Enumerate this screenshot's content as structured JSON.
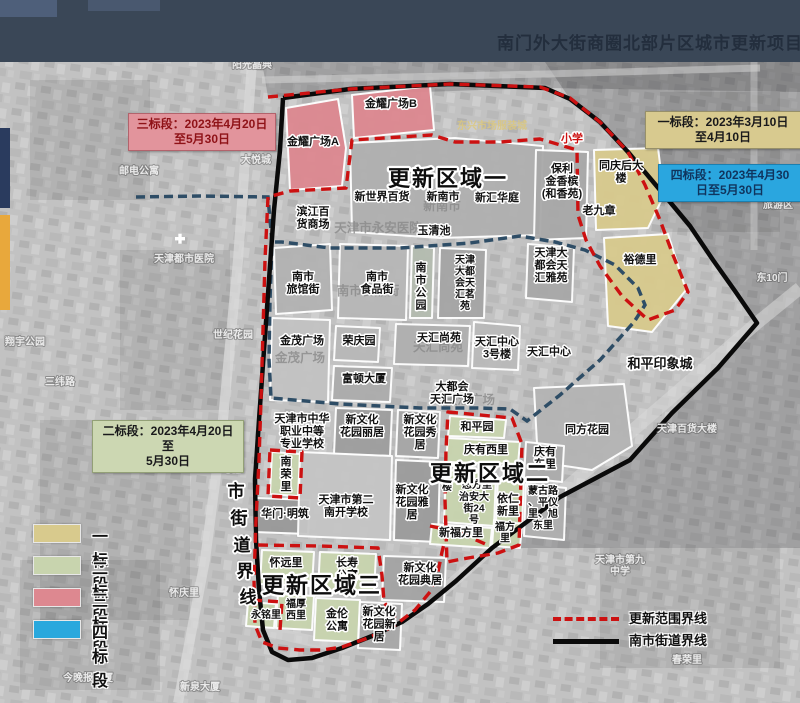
{
  "header": {
    "title": "南门外大街商圈北部片区城市更新项目"
  },
  "colors": {
    "stage1": "#d8ca8d",
    "stage2": "#c8d4ae",
    "stage3": "#dd8890",
    "stage4": "#29a8dd",
    "renewal_boundary": "#cc1111",
    "street_boundary": "#0a0a0a",
    "district_boundary": "#2e4d66",
    "header_bg": "#3a4757"
  },
  "stage_boxes": {
    "s1": {
      "line1": "一标段：2023年3月10日",
      "line2": "至4月10日"
    },
    "s2": {
      "line1": "二标段：2023年4月20日至",
      "line2": "5月30日"
    },
    "s3": {
      "line1": "三标段：2023年4月20日",
      "line2": "至5月30日"
    },
    "s4": {
      "line1": "四标段：2023年4月30",
      "line2": "日至5月30日"
    }
  },
  "legend": {
    "stages": [
      {
        "label": "一标段",
        "color": "#d8ca8d"
      },
      {
        "label": "二标段",
        "color": "#c8d4ae"
      },
      {
        "label": "三标段",
        "color": "#dd8890"
      },
      {
        "label": "四标段",
        "color": "#29a8dd"
      }
    ],
    "lines": [
      {
        "label": "更新范围界线",
        "style": "red-dashed"
      },
      {
        "label": "南市街道界线",
        "style": "black-solid"
      }
    ]
  },
  "street_boundary": {
    "text": "南市街道界线",
    "chars": [
      {
        "c": "南",
        "x": 234,
        "y": 470
      },
      {
        "c": "市",
        "x": 236,
        "y": 497
      },
      {
        "c": "街",
        "x": 239,
        "y": 524
      },
      {
        "c": "道",
        "x": 242,
        "y": 551
      },
      {
        "c": "界",
        "x": 245,
        "y": 577
      },
      {
        "c": "线",
        "x": 248,
        "y": 603
      }
    ]
  },
  "map_labels": [
    {
      "t": "新南市",
      "x": 442,
      "y": 210,
      "cls": "ghost"
    },
    {
      "t": "天津市永安医院",
      "x": 378,
      "y": 232,
      "cls": "ghost"
    },
    {
      "t": "南市食品街",
      "x": 368,
      "y": 295,
      "cls": "ghost"
    },
    {
      "t": "金茂广场",
      "x": 300,
      "y": 362,
      "cls": "ghost"
    },
    {
      "t": "天汇尚苑",
      "x": 438,
      "y": 351,
      "cls": "ghost"
    },
    {
      "t": "天汇广场",
      "x": 470,
      "y": 404,
      "cls": "ghost"
    },
    {
      "t": "阳光晶典",
      "x": 252,
      "y": 68,
      "cls": "faint"
    },
    {
      "t": "铜锣湾花园",
      "x": 500,
      "y": 56,
      "cls": "faint"
    },
    {
      "t": "邮电公寓",
      "x": 139,
      "y": 174,
      "cls": "faint"
    },
    {
      "t": "大悦城",
      "x": 256,
      "y": 163,
      "cls": "faint"
    },
    {
      "t": "天津都市医院",
      "x": 184,
      "y": 262,
      "cls": "faint"
    },
    {
      "t": "世纪花园",
      "x": 233,
      "y": 338,
      "cls": "faint"
    },
    {
      "t": "翔宇公园",
      "x": 25,
      "y": 345,
      "cls": "faint"
    },
    {
      "t": "三纬路",
      "x": 60,
      "y": 385,
      "cls": "faint"
    },
    {
      "t": "紫光苑小区",
      "x": 204,
      "y": 465,
      "cls": "faint"
    },
    {
      "t": "怀庆里",
      "x": 184,
      "y": 596,
      "cls": "faint"
    },
    {
      "t": "今晚报大厦",
      "x": 88,
      "y": 681,
      "cls": "faint"
    },
    {
      "t": "新泉大厦",
      "x": 200,
      "y": 690,
      "cls": "faint"
    },
    {
      "t": "东10门",
      "x": 772,
      "y": 281,
      "cls": "faint"
    },
    {
      "t": "旅游区",
      "x": 778,
      "y": 208,
      "cls": "faint"
    },
    {
      "t": "天津百货大楼",
      "x": 687,
      "y": 432,
      "cls": "faint"
    },
    {
      "t": "天津市第九\n中学",
      "x": 620,
      "y": 563,
      "cls": "faint"
    },
    {
      "t": "春荣里",
      "x": 687,
      "y": 663,
      "cls": "faint"
    },
    {
      "t": "东兴市场服装城",
      "x": 492,
      "y": 129,
      "cls": "faint-y"
    },
    {
      "t": "金耀广场A",
      "x": 313,
      "y": 145,
      "cls": "blk"
    },
    {
      "t": "金耀广场B",
      "x": 391,
      "y": 107,
      "cls": "blk"
    },
    {
      "t": "新世界百货",
      "x": 382,
      "y": 200,
      "cls": "blk"
    },
    {
      "t": "新南市",
      "x": 443,
      "y": 200,
      "cls": "blk"
    },
    {
      "t": "新汇华庭",
      "x": 497,
      "y": 201,
      "cls": "blk"
    },
    {
      "t": "滨江百\n货商场",
      "x": 313,
      "y": 215,
      "cls": "blk"
    },
    {
      "t": "玉清池",
      "x": 434,
      "y": 234,
      "cls": "blk"
    },
    {
      "t": "保利\n金香槟\n(和香苑)",
      "x": 562,
      "y": 172,
      "cls": "blk"
    },
    {
      "t": "小学",
      "x": 572,
      "y": 142,
      "cls": "red"
    },
    {
      "t": "同庆后大\n楼",
      "x": 621,
      "y": 169,
      "cls": "blk"
    },
    {
      "t": "老九章",
      "x": 599,
      "y": 214,
      "cls": "blk"
    },
    {
      "t": "裕德里",
      "x": 640,
      "y": 263,
      "cls": "blk"
    },
    {
      "t": "天津大\n都会天\n汇雅苑",
      "x": 551,
      "y": 256,
      "cls": "blk"
    },
    {
      "t": "南市\n旅馆街",
      "x": 303,
      "y": 280,
      "cls": "blk"
    },
    {
      "t": "南市\n食品街",
      "x": 377,
      "y": 280,
      "cls": "blk"
    },
    {
      "t": "南\n市\n公\n园",
      "x": 421,
      "y": 271,
      "cls": "blk"
    },
    {
      "t": "天津\n大都\n会天\n汇茗\n苑",
      "x": 465,
      "y": 263,
      "cls": "blk-s"
    },
    {
      "t": "金茂广场",
      "x": 302,
      "y": 344,
      "cls": "blk"
    },
    {
      "t": "荣庆园",
      "x": 359,
      "y": 344,
      "cls": "blk"
    },
    {
      "t": "天汇尚苑",
      "x": 439,
      "y": 341,
      "cls": "blk"
    },
    {
      "t": "天汇中心\n3号楼",
      "x": 497,
      "y": 345,
      "cls": "blk"
    },
    {
      "t": "天汇中心",
      "x": 549,
      "y": 355,
      "cls": "blk"
    },
    {
      "t": "富顿大厦",
      "x": 364,
      "y": 382,
      "cls": "blk"
    },
    {
      "t": "大都会\n天汇广场",
      "x": 452,
      "y": 390,
      "cls": "blk"
    },
    {
      "t": "和平印象城",
      "x": 660,
      "y": 368,
      "cls": "blk-m"
    },
    {
      "t": "同方花园",
      "x": 587,
      "y": 433,
      "cls": "blk"
    },
    {
      "t": "天津市中华\n职业中等\n专业学校",
      "x": 302,
      "y": 422,
      "cls": "blk"
    },
    {
      "t": "新文化\n花园丽居",
      "x": 362,
      "y": 423,
      "cls": "blk"
    },
    {
      "t": "新文化\n花园秀\n居",
      "x": 420,
      "y": 423,
      "cls": "blk"
    },
    {
      "t": "和平园",
      "x": 477,
      "y": 430,
      "cls": "blk"
    },
    {
      "t": "庆有西里",
      "x": 486,
      "y": 453,
      "cls": "blk"
    },
    {
      "t": "庆有\n东里",
      "x": 545,
      "y": 455,
      "cls": "blk"
    },
    {
      "t": "南\n荣\n里",
      "x": 286,
      "y": 465,
      "cls": "blk"
    },
    {
      "t": "华门·明筑",
      "x": 285,
      "y": 517,
      "cls": "blk"
    },
    {
      "t": "天津市第二\n南开学校",
      "x": 346,
      "y": 503,
      "cls": "blk"
    },
    {
      "t": "新文化\n花园雅\n居",
      "x": 412,
      "y": 493,
      "cls": "blk"
    },
    {
      "t": "楼",
      "x": 447,
      "y": 490,
      "cls": "blk-s"
    },
    {
      "t": "恕方里",
      "x": 477,
      "y": 488,
      "cls": "blk-s"
    },
    {
      "t": "治安大\n街24\n号",
      "x": 474,
      "y": 500,
      "cls": "blk-s"
    },
    {
      "t": "依仁\n新里",
      "x": 508,
      "y": 502,
      "cls": "blk"
    },
    {
      "t": "蒙古路\n、平仪\n里、旭\n东里",
      "x": 543,
      "y": 494,
      "cls": "blk-s"
    },
    {
      "t": "新福方里",
      "x": 461,
      "y": 536,
      "cls": "blk"
    },
    {
      "t": "福方\n里",
      "x": 505,
      "y": 530,
      "cls": "blk-s"
    },
    {
      "t": "怀远里",
      "x": 286,
      "y": 566,
      "cls": "blk"
    },
    {
      "t": "长寿\n公寓",
      "x": 347,
      "y": 566,
      "cls": "blk"
    },
    {
      "t": "新文化\n花园典居",
      "x": 420,
      "y": 571,
      "cls": "blk"
    },
    {
      "t": "福厚\n西里",
      "x": 296,
      "y": 607,
      "cls": "blk-s"
    },
    {
      "t": "永铭里",
      "x": 266,
      "y": 618,
      "cls": "blk-s"
    },
    {
      "t": "金伦\n公寓",
      "x": 337,
      "y": 617,
      "cls": "blk"
    },
    {
      "t": "新文化\n花园新\n居",
      "x": 379,
      "y": 615,
      "cls": "blk"
    },
    {
      "t": "更新区域一",
      "x": 388,
      "y": 186,
      "cls": "title"
    },
    {
      "t": "更新区域二",
      "x": 430,
      "y": 481,
      "cls": "title"
    },
    {
      "t": "更新区域三",
      "x": 262,
      "y": 593,
      "cls": "title"
    }
  ]
}
